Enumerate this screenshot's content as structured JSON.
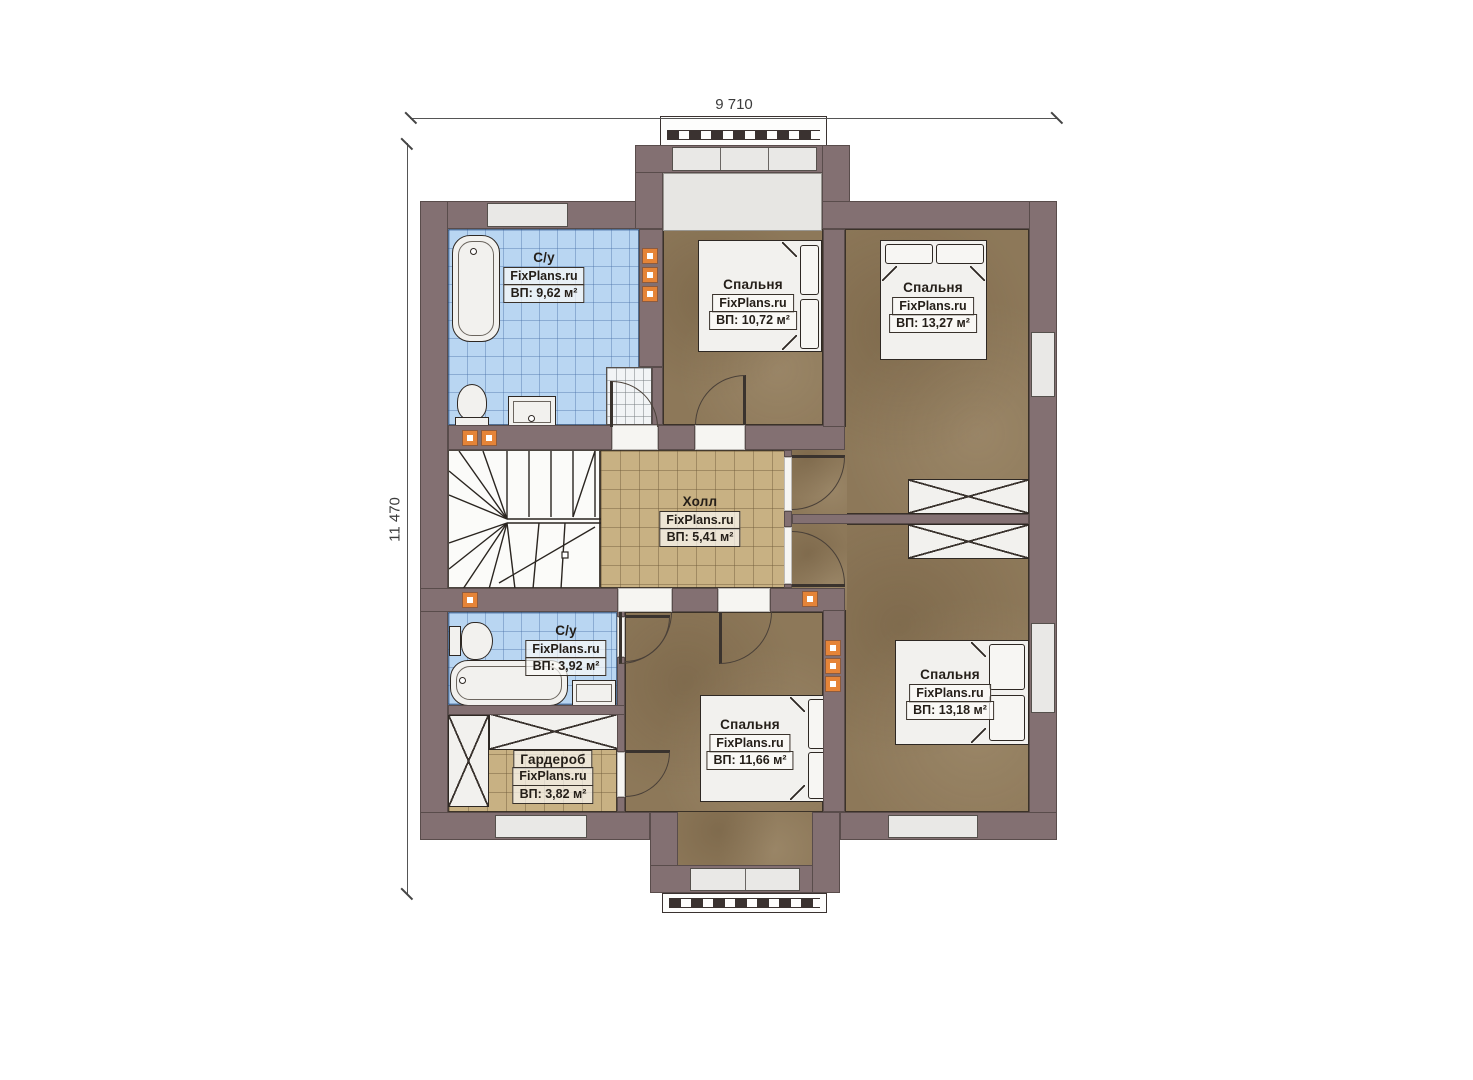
{
  "dimensions": {
    "width_label": "9 710",
    "height_label": "11 470"
  },
  "rooms": [
    {
      "id": "bathroom-top",
      "name": "С/у",
      "watermark": "FixPlans.ru",
      "area": "ВП: 9,62 м²"
    },
    {
      "id": "bedroom-top-middle",
      "name": "Спальня",
      "watermark": "FixPlans.ru",
      "area": "ВП: 10,72 м²"
    },
    {
      "id": "bedroom-top-right",
      "name": "Спальня",
      "watermark": "FixPlans.ru",
      "area": "ВП: 13,27 м²"
    },
    {
      "id": "hall",
      "name": "Холл",
      "watermark": "FixPlans.ru",
      "area": "ВП: 5,41 м²"
    },
    {
      "id": "bathroom-bottom",
      "name": "С/у",
      "watermark": "FixPlans.ru",
      "area": "ВП: 3,92 м²"
    },
    {
      "id": "wardrobe",
      "name": "Гардероб",
      "watermark": "FixPlans.ru",
      "area": "ВП: 3,82 м²"
    },
    {
      "id": "bedroom-bottom-middle",
      "name": "Спальня",
      "watermark": "FixPlans.ru",
      "area": "ВП: 11,66 м²"
    },
    {
      "id": "bedroom-bottom-right",
      "name": "Спальня",
      "watermark": "FixPlans.ru",
      "area": "ВП: 13,18 м²"
    }
  ],
  "colors": {
    "wall": "#837072",
    "bedroom_floor": "#8d7859",
    "hall_floor": "#c8b183",
    "bath_floor": "#b9d6f2",
    "window_fill": "#e9e8e6",
    "vent": "#e58438",
    "label_bg": "rgba(252,251,248,0.70)"
  }
}
